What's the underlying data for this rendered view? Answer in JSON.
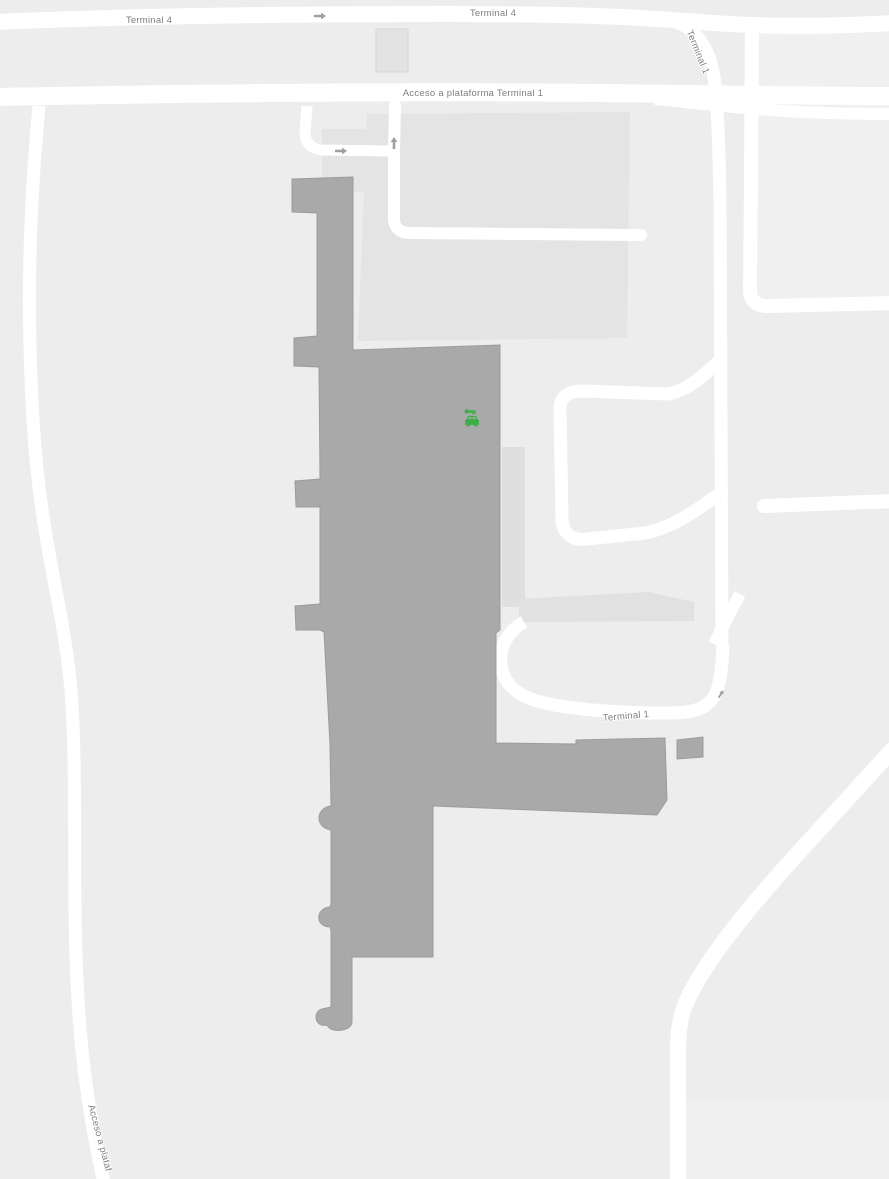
{
  "map": {
    "description": "Airport terminal area map with roads, terminal building footprint and car rental point of interest",
    "labels": {
      "road_terminal4_left": "Terminal 4",
      "road_terminal4_center": "Terminal 4",
      "road_terminal1_ramp": "Terminal 1",
      "road_acceso_plataforma": "Acceso a plataforma Terminal 1",
      "road_terminal1_loop": "Terminal 1",
      "road_acceso_bottom": "Acceso a plataf"
    },
    "poi": {
      "car_rental": {
        "name": "car-rental",
        "color": "#3fae49"
      }
    },
    "icons": [
      {
        "name": "one-way-arrow-right-icon"
      },
      {
        "name": "one-way-arrow-right-icon"
      },
      {
        "name": "one-way-arrow-up-icon"
      },
      {
        "name": "one-way-arrow-diagonal-icon"
      },
      {
        "name": "car-rental-icon"
      }
    ],
    "colors": {
      "background": "#ededed",
      "road": "#ffffff",
      "building": "#a9a9a9",
      "apron": "#e4e4e4",
      "label_text": "#7a7f83",
      "direction_arrow": "#9da0a3",
      "poi_green": "#3fae49"
    }
  }
}
